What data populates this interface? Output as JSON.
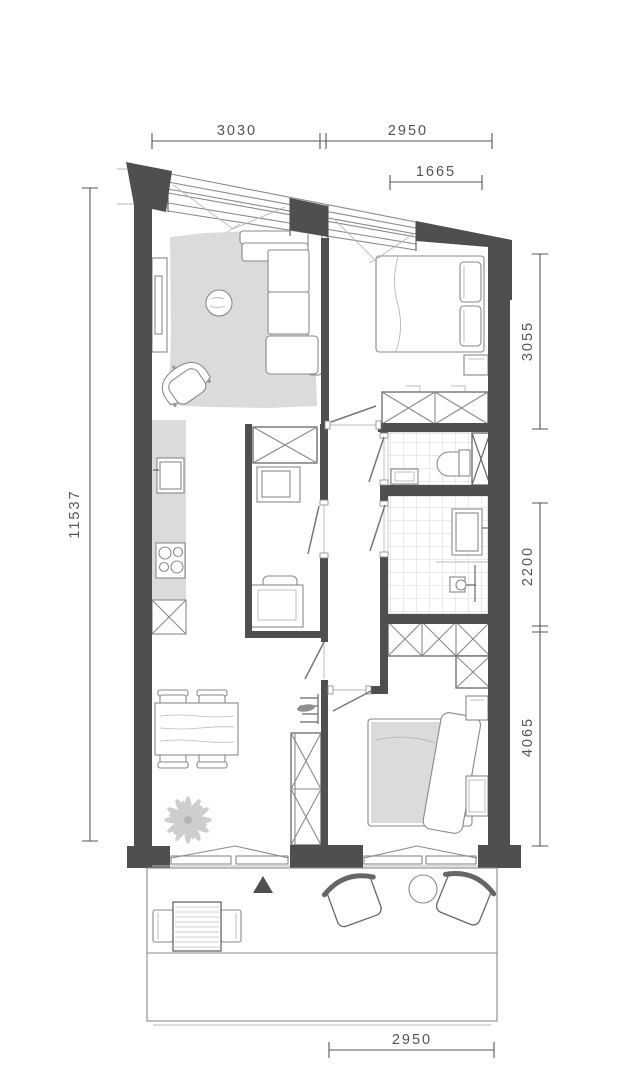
{
  "title": "apartment-floor-plan",
  "colors": {
    "wall": "#4f4f4f",
    "line": "#8a8a8a",
    "line_strong": "#666666",
    "fill_soft": "#dbdbdb",
    "dim": "#555555",
    "tile": "#cccccc",
    "plant": "#c9c9c9"
  },
  "dimensions": {
    "top_left": "3030",
    "top_right": "2950",
    "top_inset": "1665",
    "left": "11537",
    "right_upper": "3055",
    "right_middle": "2200",
    "right_lower": "4065",
    "bottom": "2950"
  }
}
